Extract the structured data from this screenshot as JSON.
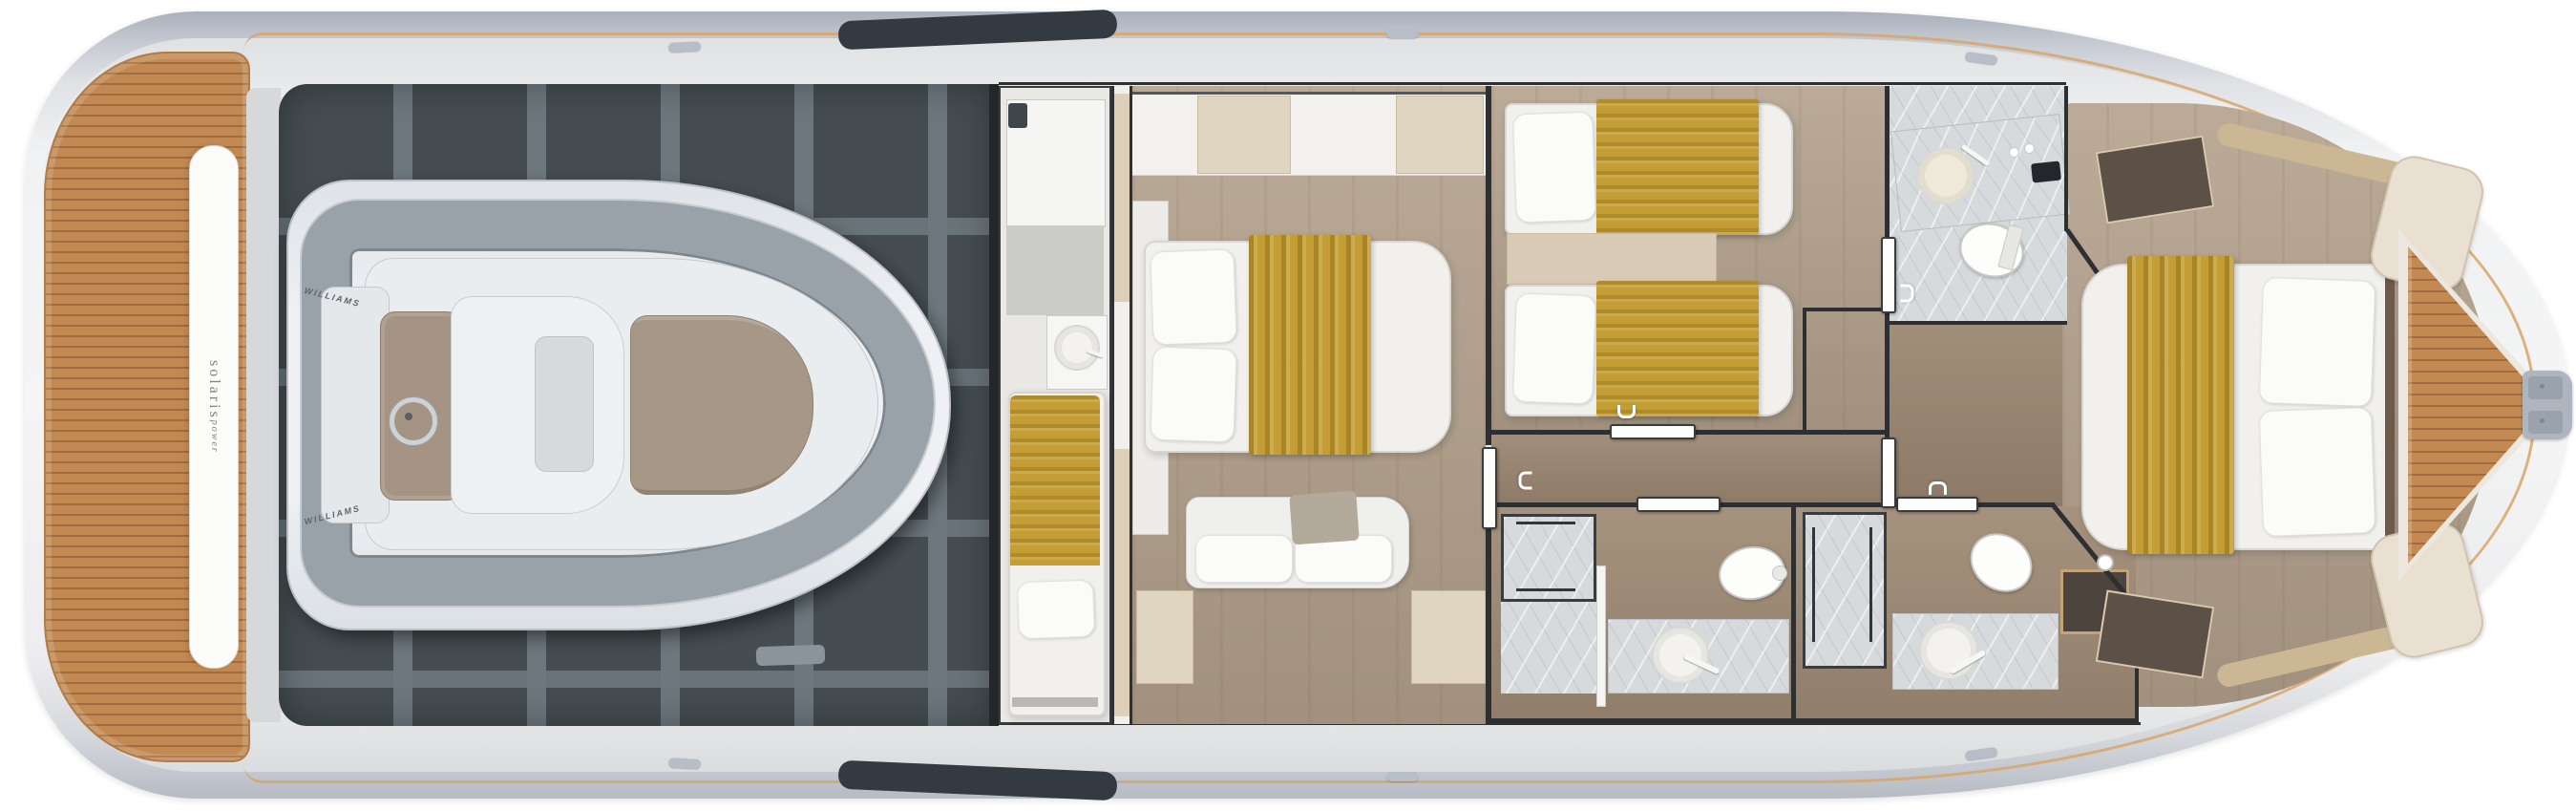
{
  "branding": {
    "transom_primary": "solaris",
    "transom_secondary": "power",
    "tender_brand": "WILLIAMS"
  },
  "palette": {
    "teak": "#c28a52",
    "teak_line": "#a06c3f",
    "caprail": "#d9a66c",
    "hull_band": "#b7bdc7",
    "hull_inner": "#f0f1f2",
    "garage_floor": "#454d51",
    "frame": "#6d787e",
    "blanket": "#c49e35",
    "wood_floor": "#b3a18c",
    "corridor_floor": "#9c8872",
    "marble": "#d7dadd",
    "wall": "#2e2f31",
    "cream": "#e9e0d1",
    "dark_cabinet": "#5d5047",
    "tender_tube": "#9aa2a9"
  }
}
